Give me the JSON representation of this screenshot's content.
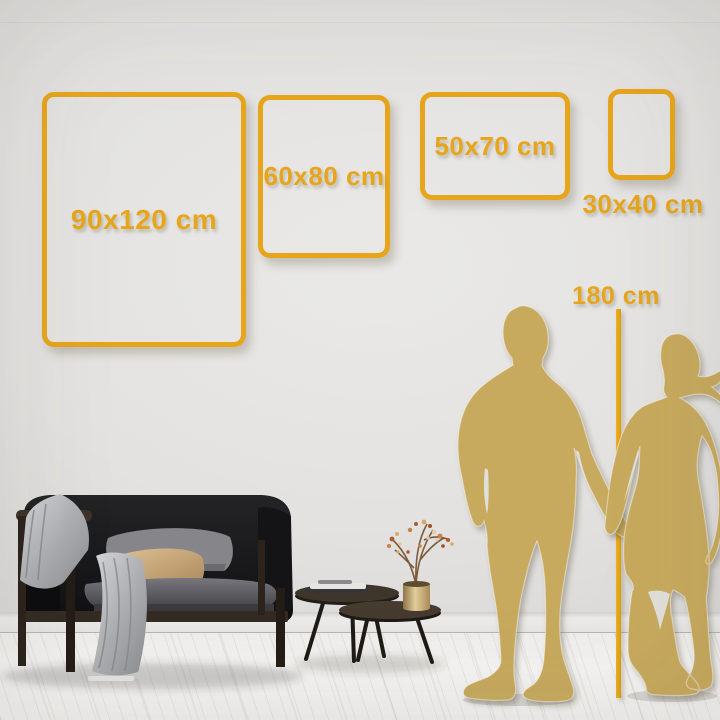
{
  "size_guide": {
    "frames": [
      {
        "id": "90x120",
        "label": "90x120 cm"
      },
      {
        "id": "60x80",
        "label": "60x80 cm"
      },
      {
        "id": "50x70",
        "label": "50x70 cm"
      },
      {
        "id": "30x40",
        "label": "30x40 cm"
      }
    ],
    "height_marker": {
      "label": "180 cm"
    }
  },
  "colors": {
    "frame_gold": "#e7a51c",
    "ruler_gold": "#dd9c0d",
    "silhouette_gold": "#c8aa5e",
    "wall": "#e3e2e0",
    "floor": "#f4f3f1",
    "sofa_dark": "#1c1c1e",
    "pillow_gray": "#828286",
    "pillow_tan": "#c9a87a",
    "blanket_gray": "#b4b5b7",
    "wood_dark": "#30281f",
    "vase_brass": "#d8c28f"
  }
}
